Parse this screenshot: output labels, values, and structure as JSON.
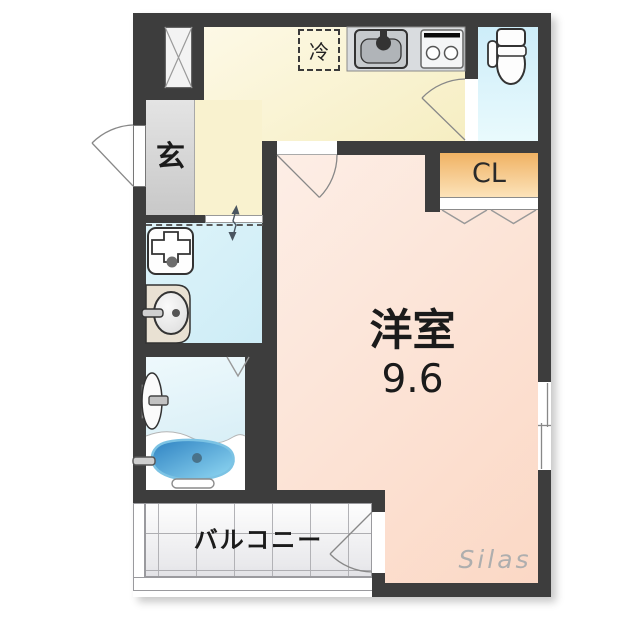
{
  "plan": {
    "type": "floor-plan",
    "labels": {
      "entrance": "玄",
      "refrigerator": "冷",
      "closet": "CL",
      "main_room_name": "洋室",
      "main_room_size": "9.6",
      "balcony": "バルコニー"
    },
    "watermark": "Silas",
    "rooms": [
      {
        "name": "entrance-genkan",
        "label": "玄"
      },
      {
        "name": "kitchen",
        "label": ""
      },
      {
        "name": "toilet-room",
        "label": ""
      },
      {
        "name": "closet",
        "label": "CL"
      },
      {
        "name": "western-room",
        "label": "洋室 9.6"
      },
      {
        "name": "washroom",
        "label": ""
      },
      {
        "name": "bathroom",
        "label": ""
      },
      {
        "name": "balcony",
        "label": "バルコニー"
      }
    ],
    "fixtures": [
      "refrigerator-box",
      "kitchen-sink",
      "gas-stove",
      "toilet",
      "pipe-shaft-box",
      "washing-machine-pan",
      "washbasin",
      "bathtub",
      "shower-fixture",
      "entrance-door",
      "toilet-door",
      "room-door",
      "balcony-door",
      "sliding-door",
      "folding-door-marks",
      "sliding-window"
    ],
    "colors": {
      "wall": "#3d3d3d",
      "kitchen_floor": "#f8f1cd",
      "entrance_floor": "#d6d6d6",
      "washroom_floor": "#d7f1f8",
      "bathroom_floor": "#e2f5fa",
      "toilet_floor": "#d6f0fa",
      "closet_fill": "#f3ba70",
      "main_room_floor": "#fce2d3",
      "bathtub_fill": "#3f93cc",
      "balcony_floor": "#f2f2f3"
    }
  }
}
